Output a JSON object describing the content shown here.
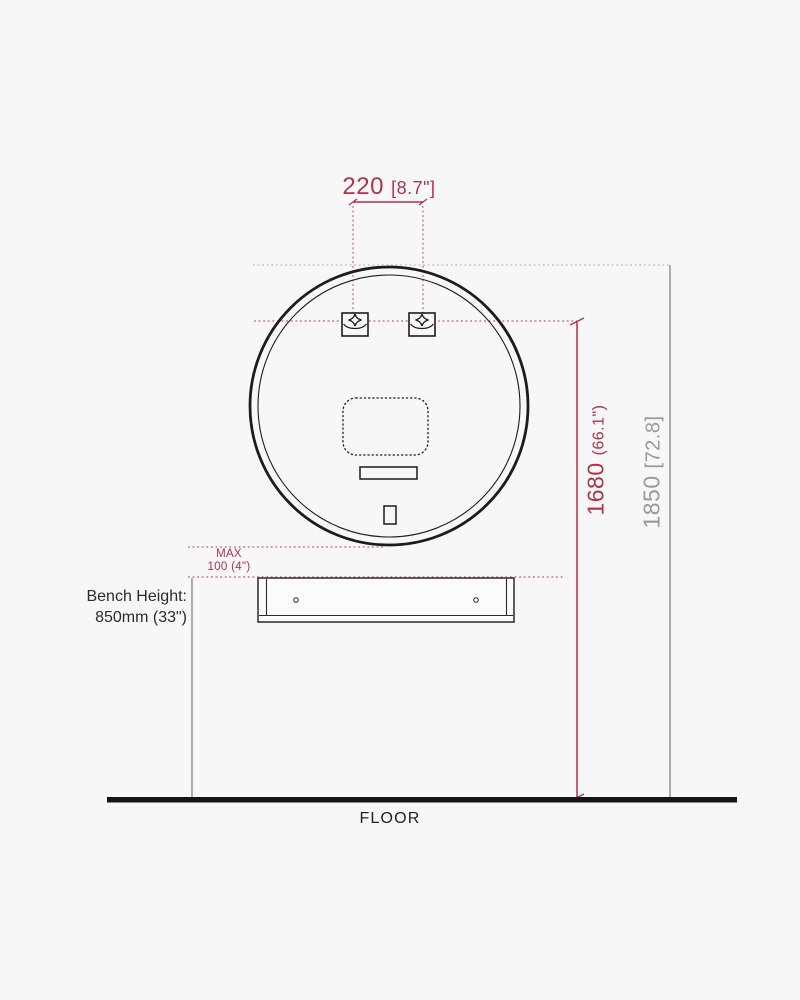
{
  "diagram": {
    "type": "installation-diagram",
    "subject": "round-mirror-wall-mounting",
    "colors": {
      "accent_red": "#ae3449",
      "neutral_gray": "#9a9a9a",
      "ink": "#1c1c1c"
    },
    "dimensions": {
      "bracket_spacing": {
        "metric": "220",
        "imperial": "[8.7\"]"
      },
      "bracket_height_from_floor": {
        "metric": "1680",
        "imperial": "(66.1\")"
      },
      "overall_height": {
        "metric": "1850",
        "imperial": "[72.8]"
      },
      "mirror_to_bench_gap": {
        "line1": "MAX",
        "line2": "100  (4\")"
      },
      "bench_height": {
        "line1": "Bench Height:",
        "line2": "850mm (33\")"
      }
    },
    "floor_label": "FLOOR"
  }
}
